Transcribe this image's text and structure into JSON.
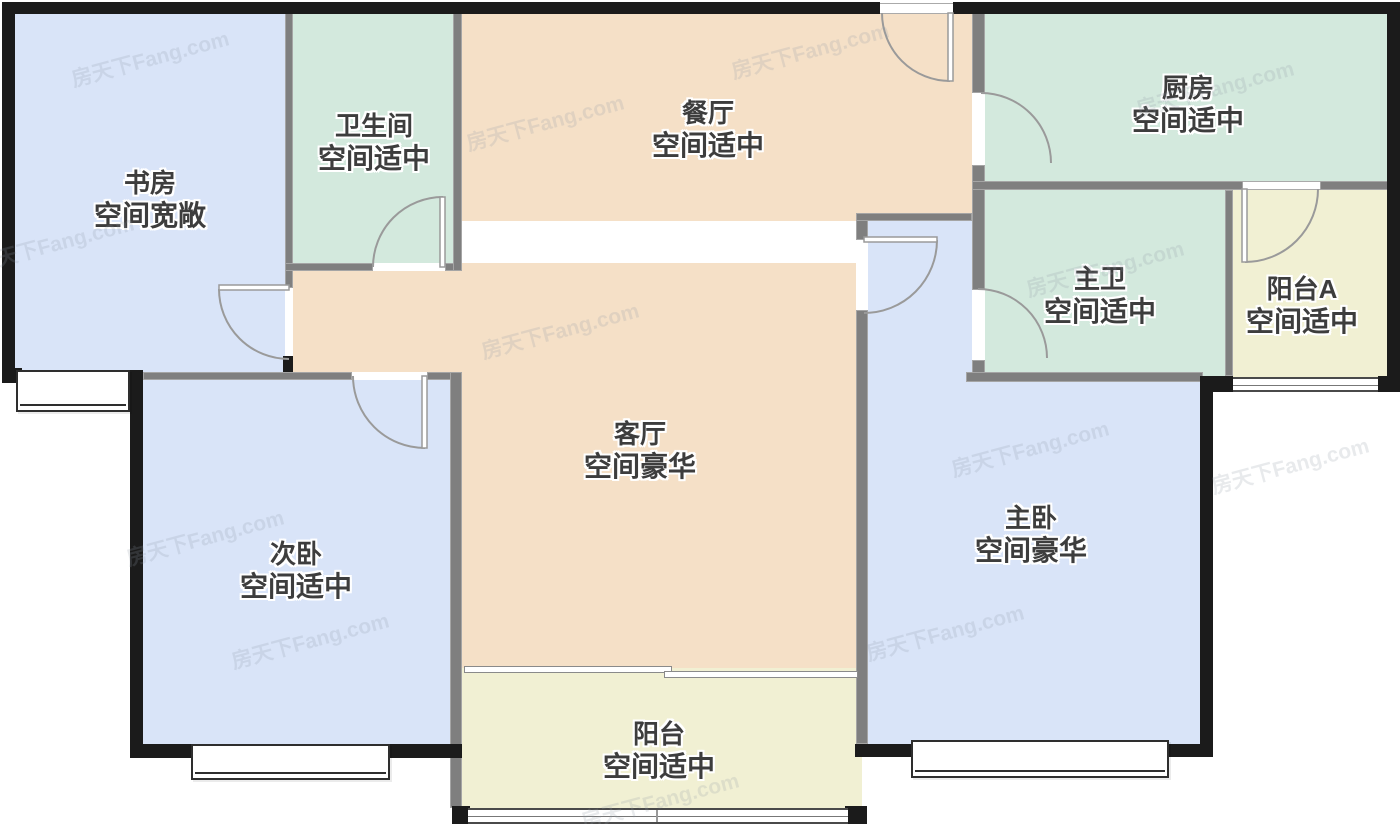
{
  "watermark": {
    "text": "房天下Fang.com"
  },
  "colors": {
    "bedroom_blue": "#d9e4f8",
    "wet_area_teal": "#d3e9dd",
    "living_peach": "#f5e0c7",
    "balcony_yellow": "#f1f0d3",
    "exterior_wall": "#1b1b1b",
    "interior_wall": "#7f7f7f",
    "door_arc": "#9a9a9a",
    "label_text": "#3d3d3d"
  },
  "rooms": [
    {
      "id": "study",
      "name": "书房",
      "quality": "空间宽敞",
      "color": "#d9e4f8"
    },
    {
      "id": "bathroom",
      "name": "卫生间",
      "quality": "空间适中",
      "color": "#d3e9dd"
    },
    {
      "id": "dining",
      "name": "餐厅",
      "quality": "空间适中",
      "color": "#f5e0c7"
    },
    {
      "id": "kitchen",
      "name": "厨房",
      "quality": "空间适中",
      "color": "#d3e9dd"
    },
    {
      "id": "master-bath",
      "name": "主卫",
      "quality": "空间适中",
      "color": "#d3e9dd"
    },
    {
      "id": "balcony-a",
      "name": "阳台A",
      "quality": "空间适中",
      "color": "#f1f0d3"
    },
    {
      "id": "living-room",
      "name": "客厅",
      "quality": "空间豪华",
      "color": "#f5e0c7"
    },
    {
      "id": "second-bedroom",
      "name": "次卧",
      "quality": "空间适中",
      "color": "#d9e4f8"
    },
    {
      "id": "master-bedroom",
      "name": "主卧",
      "quality": "空间豪华",
      "color": "#d9e4f8"
    },
    {
      "id": "balcony",
      "name": "阳台",
      "quality": "空间适中",
      "color": "#f1f0d3"
    }
  ]
}
